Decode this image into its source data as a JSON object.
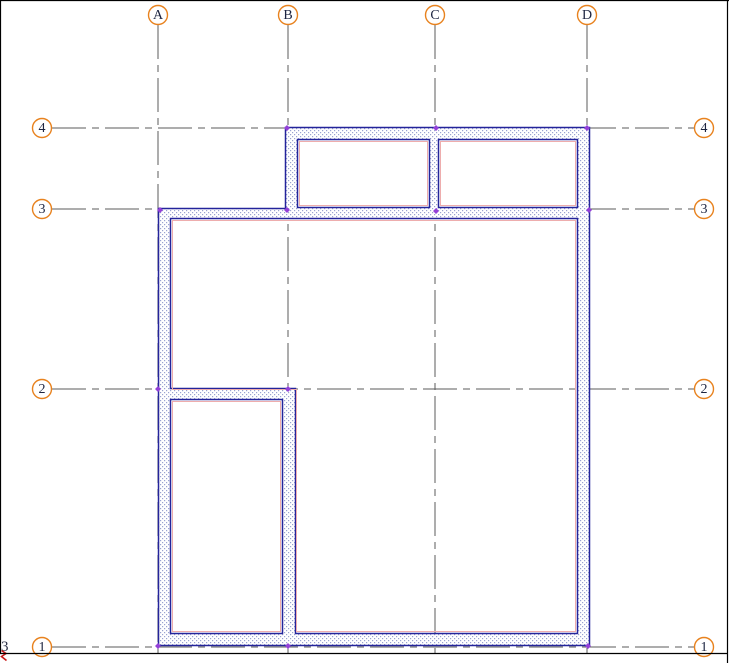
{
  "view": {
    "type": "floor-plan-drawing-area",
    "background": "#ffffff"
  },
  "grids": {
    "columns": [
      {
        "label": "A",
        "x": 158
      },
      {
        "label": "B",
        "x": 288
      },
      {
        "label": "C",
        "x": 435
      },
      {
        "label": "D",
        "x": 587
      }
    ],
    "rows": [
      {
        "label": "4",
        "y": 128
      },
      {
        "label": "3",
        "y": 209
      },
      {
        "label": "2",
        "y": 389
      },
      {
        "label": "1",
        "y": 647
      }
    ]
  },
  "walls": [
    {
      "name": "north-wall",
      "along": "grid-4",
      "from": "B",
      "to": "D",
      "kind": "exterior"
    },
    {
      "name": "west-upper-wall",
      "along": "grid-B",
      "from": "4",
      "to": "3",
      "kind": "exterior"
    },
    {
      "name": "partition-C-upper",
      "along": "grid-C",
      "from": "4",
      "to": "3",
      "kind": "interior"
    },
    {
      "name": "east-wall",
      "along": "grid-D",
      "from": "4",
      "to": "1",
      "kind": "exterior"
    },
    {
      "name": "mid-wall",
      "along": "grid-3",
      "from": "A",
      "to": "D",
      "kind": "mixed"
    },
    {
      "name": "west-wall",
      "along": "grid-A",
      "from": "3",
      "to": "1",
      "kind": "exterior"
    },
    {
      "name": "partition-2",
      "along": "grid-2",
      "from": "A",
      "to": "B",
      "kind": "interior"
    },
    {
      "name": "partition-B-lower",
      "along": "grid-B",
      "from": "2",
      "to": "1",
      "kind": "interior"
    },
    {
      "name": "south-wall",
      "along": "grid-1",
      "from": "A",
      "to": "D",
      "kind": "exterior"
    }
  ],
  "corner_annotation": {
    "text": "3"
  },
  "colors": {
    "grid_bubble": "#e8821e",
    "grid_line": "#5b5b5b",
    "wall_edge": "#24249b",
    "wall_hatch_dot": "#9aa3d0",
    "finish_face_line": "#eeadad",
    "endpoint_marker": "#9340d8",
    "section_mark": "#c81818",
    "label_text": "#1c2440",
    "view_border": "#000000"
  }
}
